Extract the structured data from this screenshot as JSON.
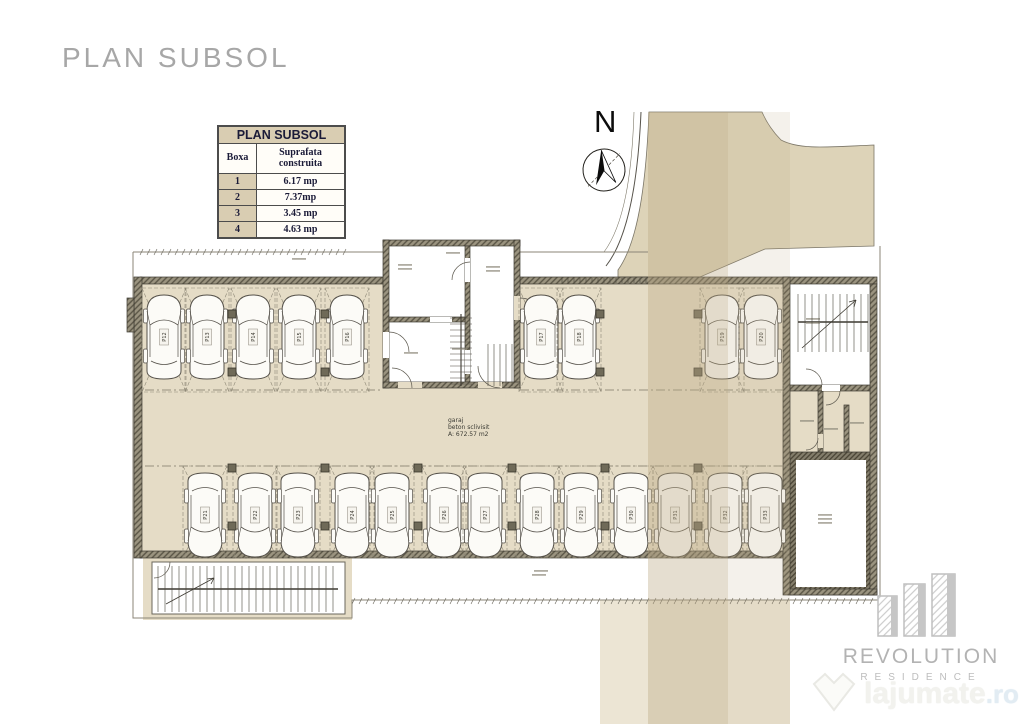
{
  "page": {
    "title": "PLAN SUBSOL"
  },
  "legend_table": {
    "title": "PLAN SUBSOL",
    "columns": [
      "Boxa",
      "Suprafata construita"
    ],
    "rows": [
      [
        "1",
        "6.17 mp"
      ],
      [
        "2",
        "7.37mp"
      ],
      [
        "3",
        "3.45 mp"
      ],
      [
        "4",
        "4.63 mp"
      ]
    ]
  },
  "compass": {
    "label": "N"
  },
  "plan": {
    "garage_label": [
      "garaj",
      "beton sclivisit",
      "A: 672.57 m2"
    ],
    "columns": [
      [
        232,
        314
      ],
      [
        325,
        314
      ],
      [
        600,
        314
      ],
      [
        698,
        314
      ],
      [
        232,
        372
      ],
      [
        325,
        372
      ],
      [
        600,
        372
      ],
      [
        698,
        372
      ],
      [
        232,
        468
      ],
      [
        325,
        468
      ],
      [
        418,
        468
      ],
      [
        512,
        468
      ],
      [
        605,
        468
      ],
      [
        698,
        468
      ],
      [
        232,
        526
      ],
      [
        325,
        526
      ],
      [
        418,
        526
      ],
      [
        512,
        526
      ],
      [
        605,
        526
      ],
      [
        698,
        526
      ]
    ],
    "parking": {
      "top_row": [
        {
          "label": "P12",
          "cx": 164
        },
        {
          "label": "P13",
          "cx": 207
        },
        {
          "label": "P14",
          "cx": 253
        },
        {
          "label": "P15",
          "cx": 299
        },
        {
          "label": "P16",
          "cx": 347
        },
        {
          "label": "P17",
          "cx": 541
        },
        {
          "label": "P18",
          "cx": 579
        },
        {
          "label": "P19",
          "cx": 722
        },
        {
          "label": "P20",
          "cx": 761,
          "cross": false
        }
      ],
      "bottom_row": [
        {
          "label": "P21",
          "cx": 205
        },
        {
          "label": "P22",
          "cx": 255
        },
        {
          "label": "P23",
          "cx": 298
        },
        {
          "label": "P24",
          "cx": 352
        },
        {
          "label": "P25",
          "cx": 392
        },
        {
          "label": "P26",
          "cx": 444
        },
        {
          "label": "P27",
          "cx": 485
        },
        {
          "label": "P28",
          "cx": 537
        },
        {
          "label": "P29",
          "cx": 581
        },
        {
          "label": "P30",
          "cx": 631
        },
        {
          "label": "P31",
          "cx": 675
        },
        {
          "label": "P32",
          "cx": 725
        },
        {
          "label": "P33",
          "cx": 765,
          "cross": false
        }
      ]
    },
    "colors": {
      "floor_fill": "#e5dcc6",
      "terrain_fill": "#ddd3b8",
      "wall_tone": "#9b9480",
      "line_tone": "#3c3931",
      "scan_band": "rgba(187,168,131,0.38)"
    }
  },
  "branding": {
    "name": "REVOLUTION",
    "sub": "RESIDENCE"
  },
  "watermark": {
    "text": "lajumate",
    "tld": ".ro"
  }
}
